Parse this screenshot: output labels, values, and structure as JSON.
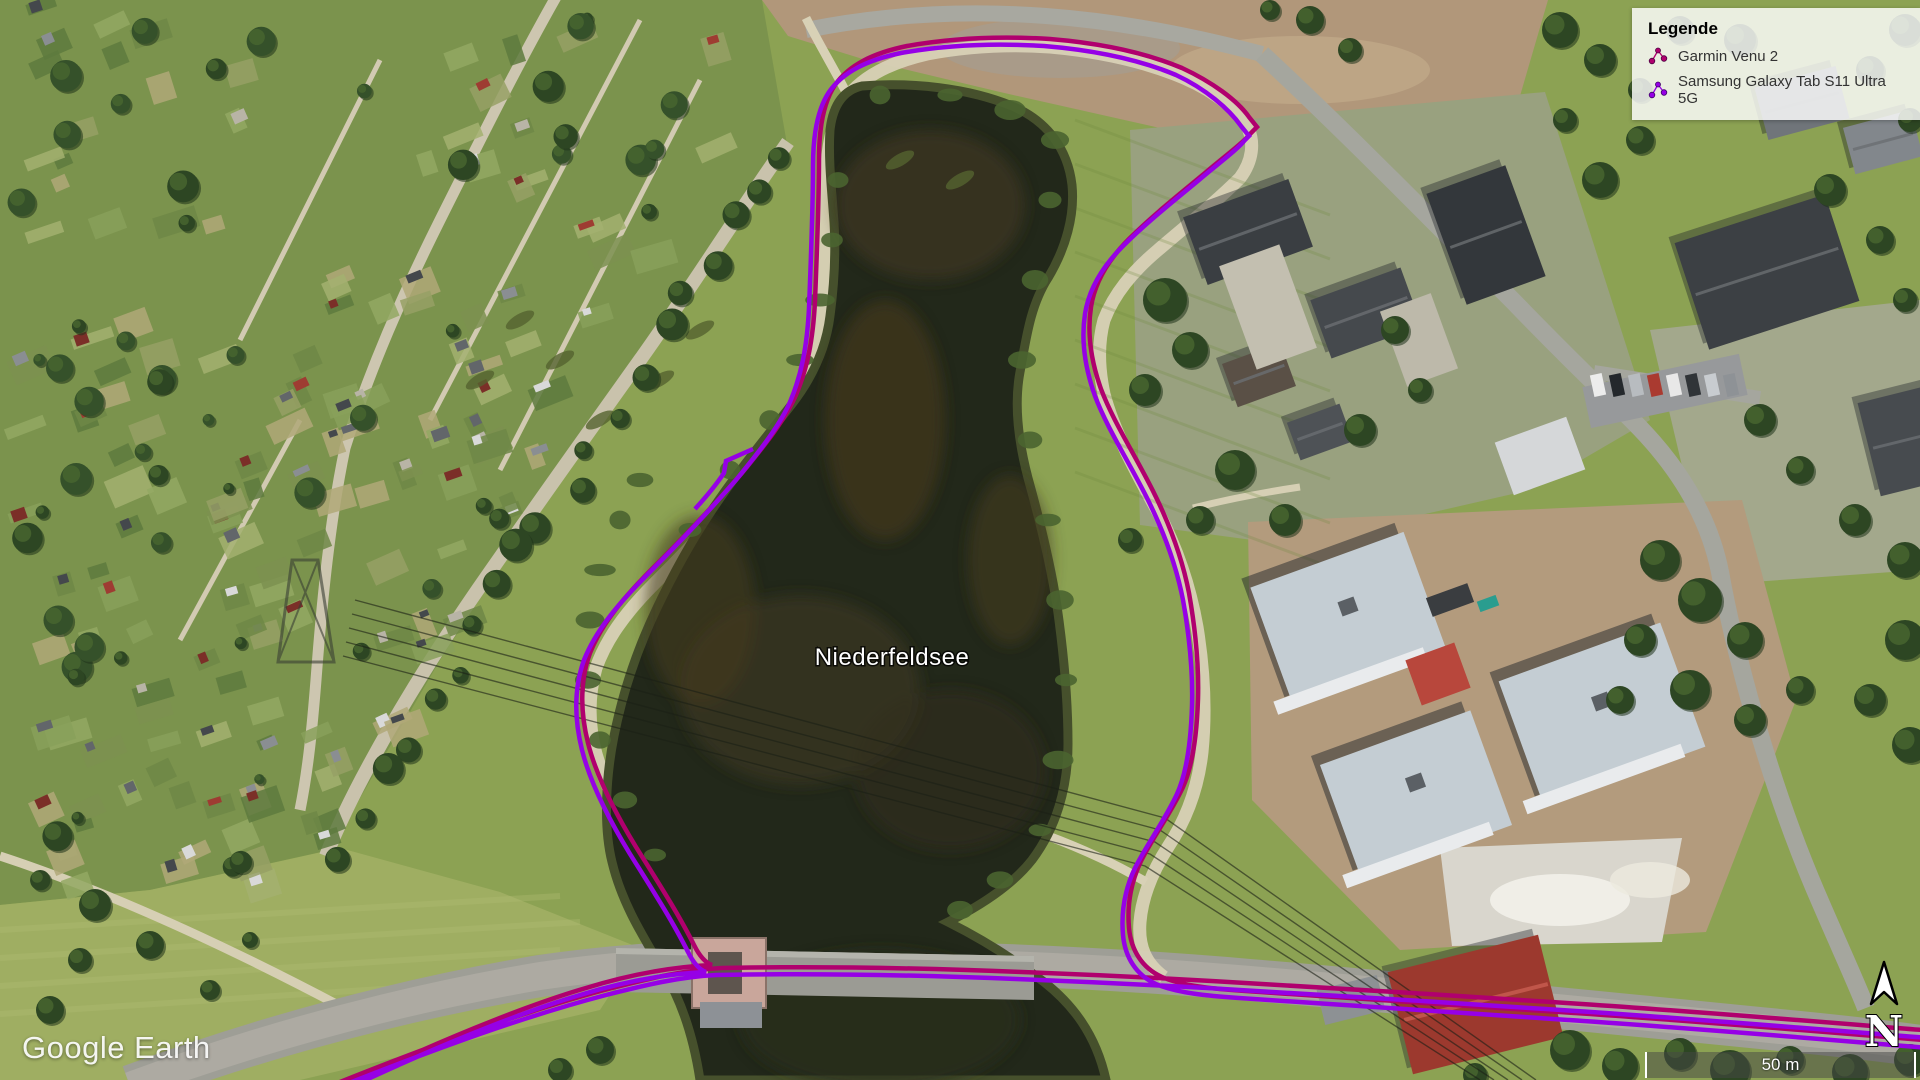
{
  "map_overlay": {
    "lake_label": "Niederfeldsee",
    "watermark": "Google Earth",
    "scale_bar": {
      "label": "50 m"
    },
    "compass": {
      "label": "N"
    }
  },
  "legend": {
    "title": "Legende",
    "items": [
      {
        "label": "Garmin Venu 2",
        "color": "#B0006E"
      },
      {
        "label": "Samsung Galaxy Tab S11 Ultra 5G",
        "color": "#9600E6"
      }
    ]
  },
  "tracks": {
    "garmin": {
      "name": "Garmin Venu 2",
      "color": "#B0006E"
    },
    "samsung": {
      "name": "Samsung Galaxy Tab S11 Ultra 5G",
      "color": "#9600E6"
    }
  }
}
